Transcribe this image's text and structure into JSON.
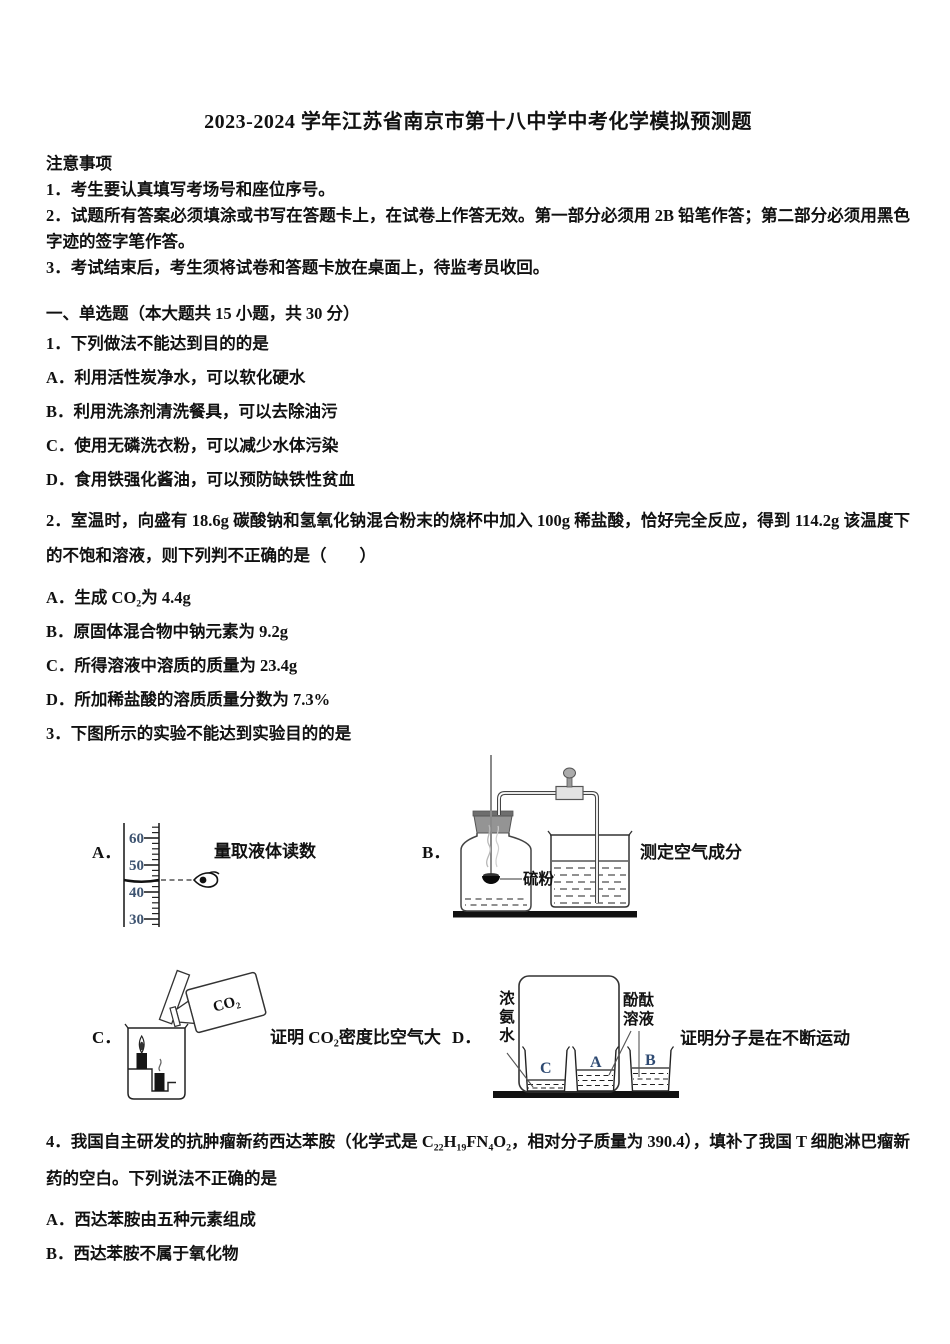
{
  "title": "2023-2024 学年江苏省南京市第十八中学中考化学模拟预测题",
  "notice": {
    "heading": "注意事项",
    "items": [
      "1．考生要认真填写考场号和座位序号。",
      "2．试题所有答案必须填涂或书写在答题卡上，在试卷上作答无效。第一部分必须用 2B 铅笔作答；第二部分必须用黑色字迹的签字笔作答。",
      "3．考试结束后，考生须将试卷和答题卡放在桌面上，待监考员收回。"
    ]
  },
  "section": {
    "heading": "一、单选题（本大题共 15 小题，共 30 分）"
  },
  "questions": {
    "q1": {
      "stem": "1．下列做法不能达到目的的是",
      "options": [
        "A．利用活性炭净水，可以软化硬水",
        "B．利用洗涤剂清洗餐具，可以去除油污",
        "C．使用无磷洗衣粉，可以减少水体污染",
        "D．食用铁强化酱油，可以预防缺铁性贫血"
      ]
    },
    "q2": {
      "stem": "2．室温时，向盛有 18.6g 碳酸钠和氢氧化钠混合粉末的烧杯中加入 100g 稀盐酸，恰好完全反应，得到 114.2g 该温度下的不饱和溶液，则下列判不正确的是（　　）",
      "options": [
        "A．生成 CO₂为 4.4g",
        "B．原固体混合物中钠元素为 9.2g",
        "C．所得溶液中溶质的质量为 23.4g",
        "D．所加稀盐酸的溶质质量分数为 7.3%"
      ]
    },
    "q3": {
      "stem": "3．下图所示的实验不能达到实验目的的是",
      "figures": {
        "a": {
          "letter": "A．",
          "caption": "量取液体读数",
          "scale": [
            "60",
            "50",
            "40",
            "30"
          ]
        },
        "b": {
          "letter": "B．",
          "caption": "测定空气成分",
          "sulfur_label": "硫粉"
        },
        "c": {
          "letter": "C．",
          "caption": "证明 CO₂密度比空气大",
          "gas_label": "CO₂"
        },
        "d": {
          "letter": "D．",
          "caption": "证明分子是在不断运动",
          "ammonia_label": "浓氨水",
          "phenolphthalein_label": "酚酞溶液",
          "beaker_labels": [
            "C",
            "A",
            "B"
          ]
        }
      }
    },
    "q4": {
      "stem": "4．我国自主研发的抗肿瘤新药西达苯胺（化学式是 C₂₂H₁₉FN₄O₂，相对分子质量为 390.4），填补了我国 T 细胞淋巴瘤新药的空白。下列说法不正确的是",
      "options": [
        "A．西达苯胺由五种元素组成",
        "B．西达苯胺不属于氧化物"
      ]
    }
  },
  "colors": {
    "scale_numeral": "#3d5370",
    "beaker_letter": "#2e4a72",
    "ink": "#111111"
  }
}
